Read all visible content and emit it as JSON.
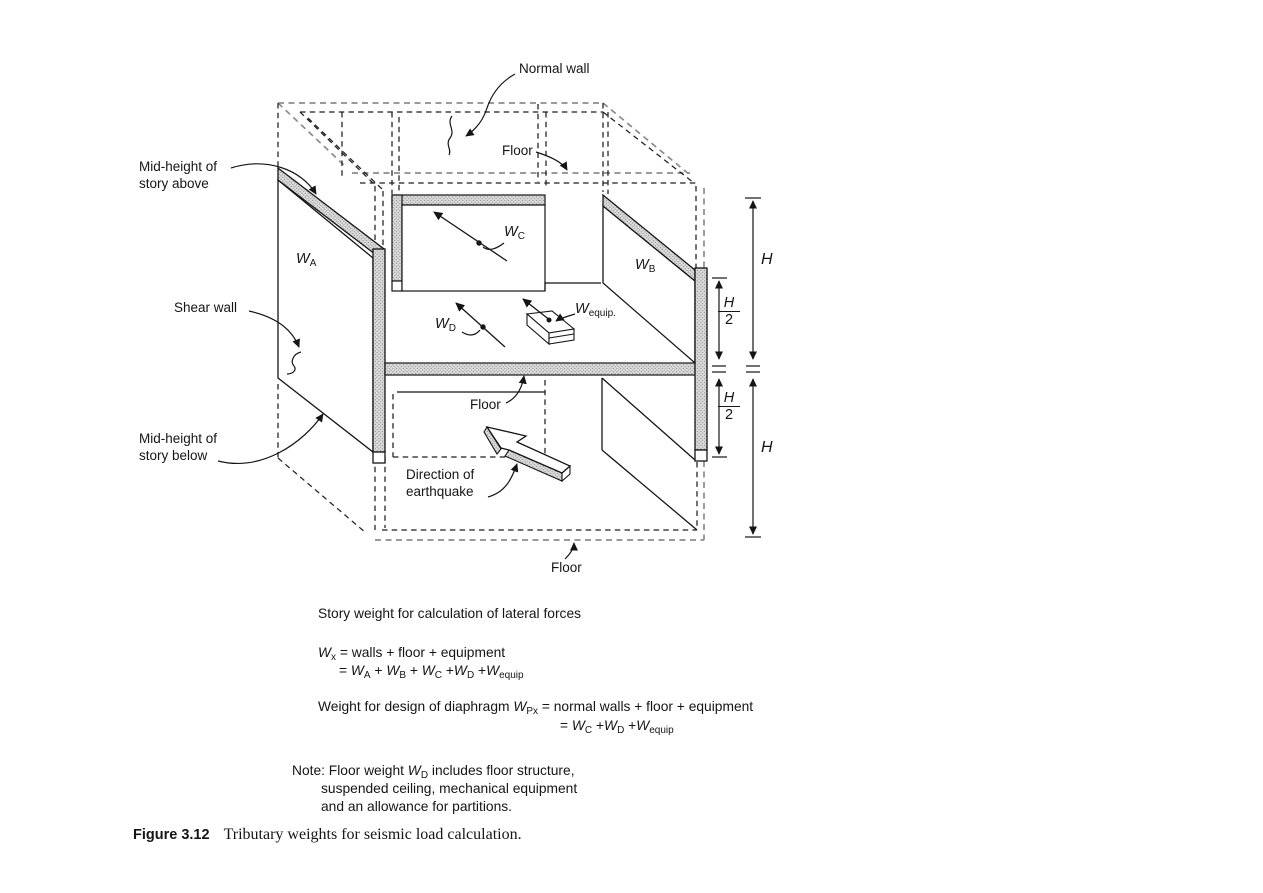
{
  "figure": {
    "caption_label": "Figure 3.12",
    "caption_text": "Tributary weights for seismic load calculation."
  },
  "colors": {
    "background": "#ffffff",
    "line": "#1a1a1a",
    "dashed_gray": "#8c8c8c",
    "hatch_fill": "#dcdcdc",
    "hatch_dot": "#8f8f8f"
  },
  "diagram": {
    "annotations": {
      "normal_wall": "Normal wall",
      "floor_top": "Floor",
      "floor_mid": "Floor",
      "floor_bottom": "Floor",
      "mid_height_above_line1": "Mid-height of",
      "mid_height_above_line2": "story above",
      "shear_wall": "Shear wall",
      "mid_height_below_line1": "Mid-height of",
      "mid_height_below_line2": "story below",
      "direction_line1": "Direction of",
      "direction_line2": "earthquake"
    },
    "weights": {
      "wa": [
        {
          "b": "W",
          "s": "A"
        }
      ],
      "wb": [
        {
          "b": "W",
          "s": "B"
        }
      ],
      "wc": [
        {
          "b": "W",
          "s": "C"
        }
      ],
      "wd": [
        {
          "b": "W",
          "s": "D"
        }
      ],
      "wequip": [
        {
          "b": "W",
          "s": "equip."
        }
      ]
    },
    "dimensions": {
      "h_upper": "H",
      "h_lower": "H",
      "h2_upper_num": "H",
      "h2_upper_den": "2",
      "h2_lower_num": "H",
      "h2_lower_den": "2"
    }
  },
  "formulas": {
    "heading": "Story weight for calculation of lateral forces",
    "story_line1": [
      {
        "b": "W",
        "s": "x"
      },
      {
        "t": " = walls + floor + equipment"
      }
    ],
    "story_line2": [
      {
        "t": "= "
      },
      {
        "b": "W",
        "s": "A"
      },
      {
        "t": " + "
      },
      {
        "b": "W",
        "s": "B"
      },
      {
        "t": " + "
      },
      {
        "b": "W",
        "s": "C"
      },
      {
        "t": " +"
      },
      {
        "b": "W",
        "s": "D"
      },
      {
        "t": " +"
      },
      {
        "b": "W",
        "s": "equip"
      }
    ],
    "diaphragm_line1": [
      {
        "t": "Weight for design of diaphragm "
      },
      {
        "b": "W",
        "s": "Px"
      },
      {
        "t": " = normal walls + floor + equipment"
      }
    ],
    "diaphragm_line2": [
      {
        "t": "= "
      },
      {
        "b": "W",
        "s": "C"
      },
      {
        "t": " +"
      },
      {
        "b": "W",
        "s": "D"
      },
      {
        "t": " +"
      },
      {
        "b": "W",
        "s": "equip"
      }
    ],
    "note_line1": [
      {
        "t": "Note: Floor weight "
      },
      {
        "b": "W",
        "s": "D"
      },
      {
        "t": " includes floor structure,"
      }
    ],
    "note_line2": "suspended ceiling, mechanical equipment",
    "note_line3": "and an allowance for partitions."
  }
}
